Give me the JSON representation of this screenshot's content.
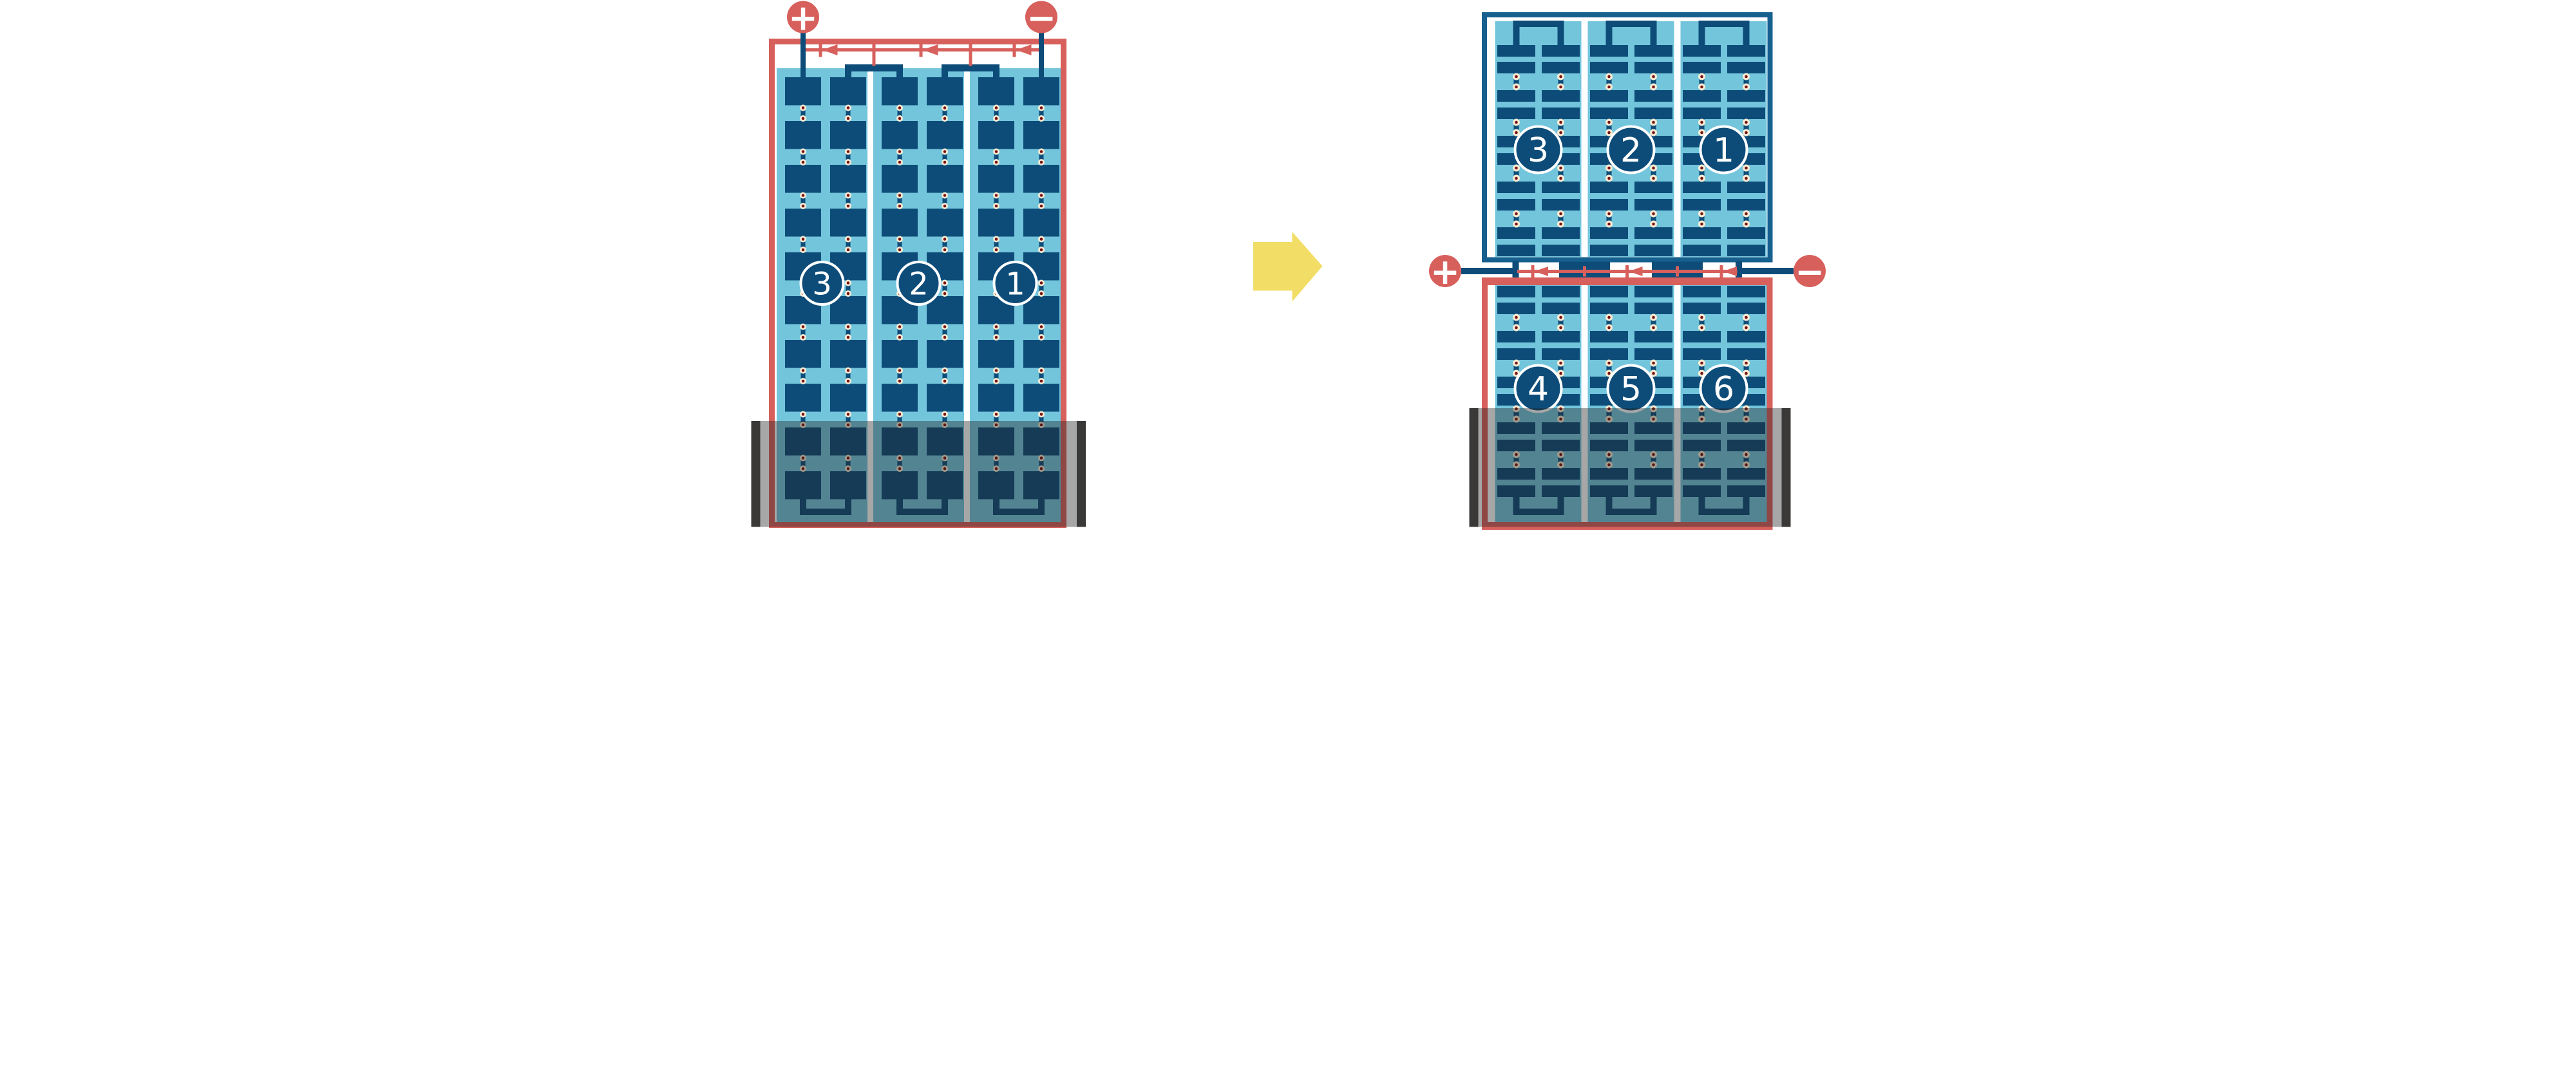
{
  "colors": {
    "background": "#ffffff",
    "wire_red": "#D7605C",
    "cell_navy": "#0D4C79",
    "frame_blue": "#16608F",
    "panel_blue": "#73C5DC",
    "solder_ring": "#F6ECD3",
    "solder_core": "#7A1116",
    "shade_overlay": "rgba(35,35,35,0.40)",
    "shade_cap": "#3B3937",
    "arrow_yellow": "#F2DE67",
    "number_text": "#ffffff",
    "terminal_text": "#ffffff"
  },
  "left_module": {
    "positive_terminal": "+",
    "negative_terminal": "−",
    "sections": [
      {
        "label": "3"
      },
      {
        "label": "2"
      },
      {
        "label": "1"
      }
    ]
  },
  "transform_arrow": {
    "direction": "right"
  },
  "right_module": {
    "positive_terminal": "+",
    "negative_terminal": "−",
    "top_panel": {
      "sections": [
        {
          "label": "3"
        },
        {
          "label": "2"
        },
        {
          "label": "1"
        }
      ]
    },
    "bottom_panel": {
      "sections": [
        {
          "label": "4"
        },
        {
          "label": "5"
        },
        {
          "label": "6"
        }
      ]
    }
  }
}
